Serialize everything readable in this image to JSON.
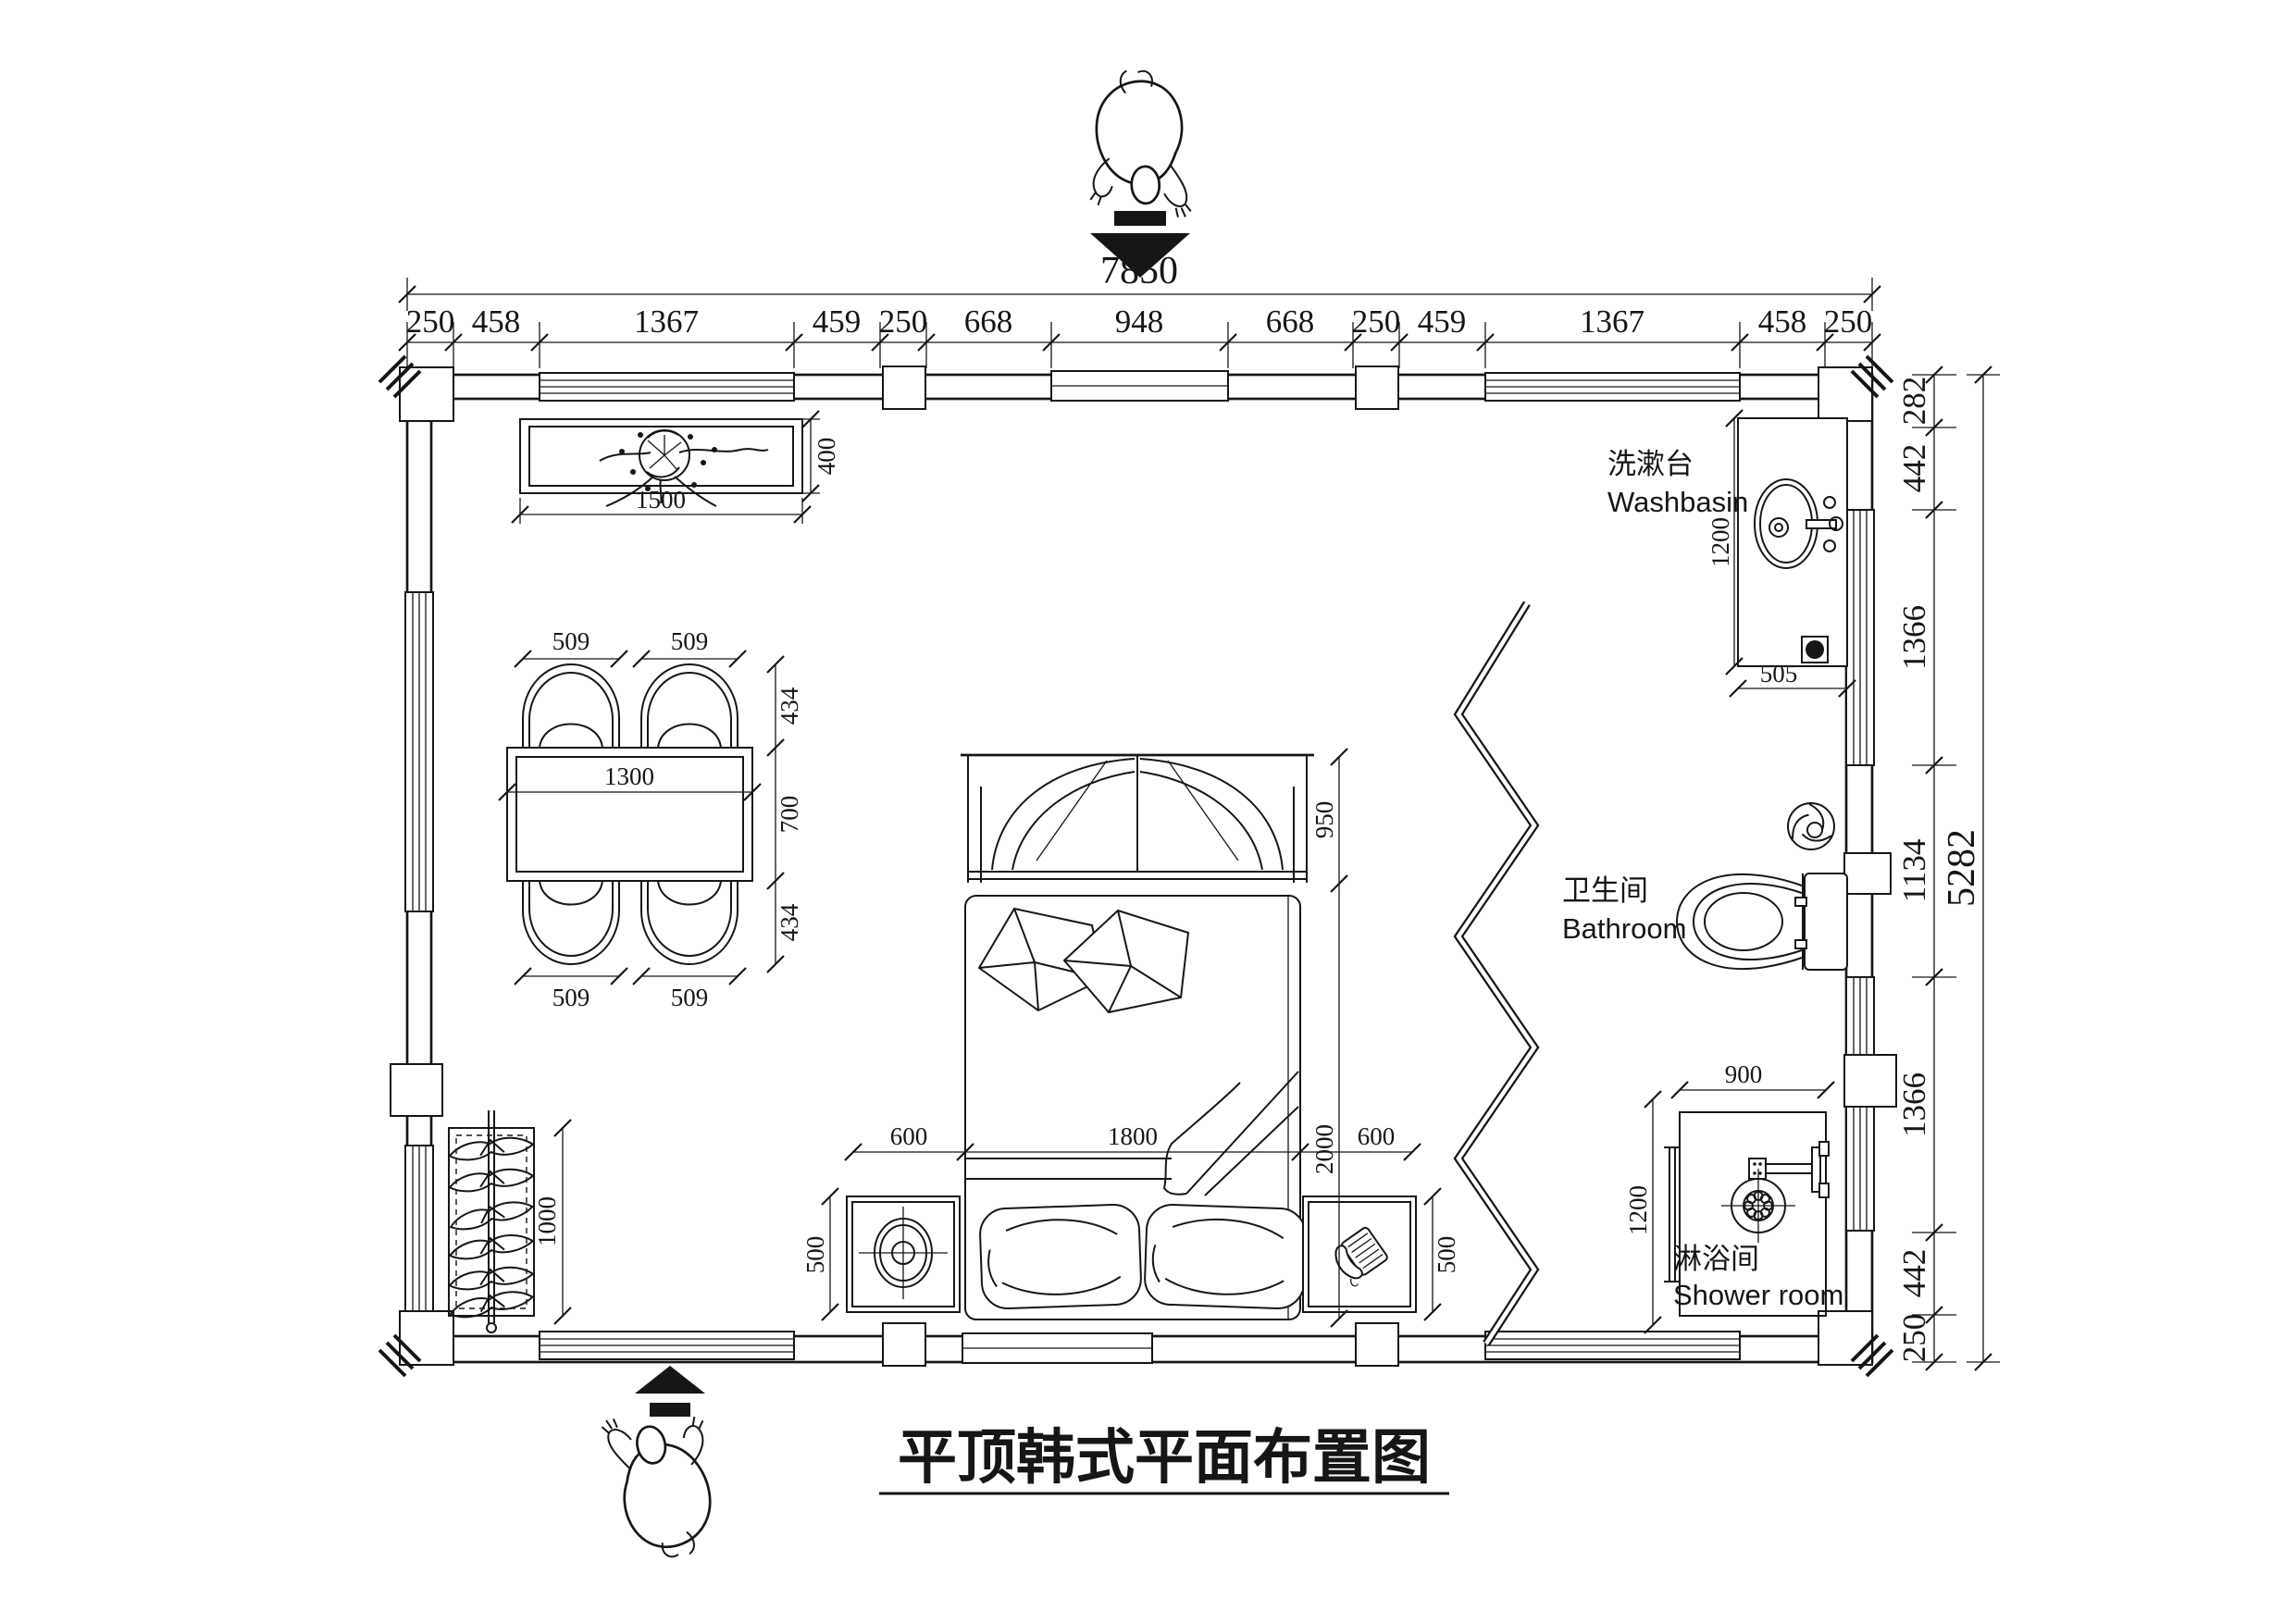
{
  "title": "平顶韩式平面布置图",
  "rooms": {
    "washbasin_zh": "洗漱台",
    "washbasin_en": "Washbasin",
    "bathroom_zh": "卫生间",
    "bathroom_en": "Bathroom",
    "shower_zh": "淋浴间",
    "shower_en": "Shower room"
  },
  "dims": {
    "total_width": "7850",
    "top_chain": [
      "250",
      "458",
      "1367",
      "459",
      "250",
      "668",
      "948",
      "668",
      "250",
      "459",
      "1367",
      "458",
      "250"
    ],
    "total_height": "5282",
    "right_chain": [
      "282",
      "442",
      "1366",
      "1134",
      "1366",
      "442",
      "250"
    ],
    "console_width": "1500",
    "console_depth": "400",
    "chair_width": "509",
    "chair_depth": "434",
    "table_width": "1300",
    "table_depth": "700",
    "wardrobe_length": "1000",
    "bed_side": "600",
    "bed_width": "1800",
    "bed_length": "2000",
    "bay_depth": "950",
    "nightstand": "500",
    "vanity_length": "1200",
    "vanity_width": "505",
    "shower_width": "900",
    "shower_length": "1200"
  }
}
